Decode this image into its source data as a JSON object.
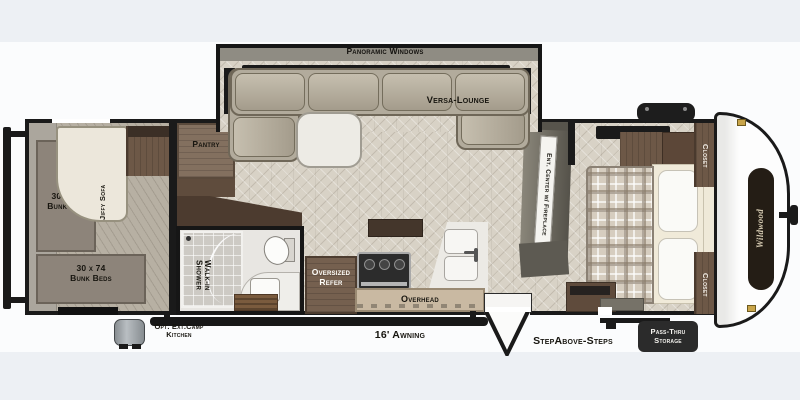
{
  "title": "Travel trailer floor plan",
  "labels": {
    "panoramic_windows": "Panoramic Windows",
    "versa_lounge": "Versa-Lounge",
    "pantry": "Pantry",
    "bunk_top_line1": "30 x 74",
    "bunk_top_line2": "Bunk Bed",
    "jiffy_sofa": "Jiffy Sofa",
    "bunk_bottom_line1": "30 x 74",
    "bunk_bottom_line2": "Bunk Beds",
    "walk_in": "Walk-in",
    "shower": "Shower",
    "oversized": "Oversized",
    "refer": "Refer",
    "overhead": "Overhead",
    "ent_center": "Ent. Center w/ Fireplace",
    "closet_top": "Closet",
    "closet_bottom": "Closet",
    "awning": "16' Awning",
    "steps": "StepAbove-Steps",
    "pass_thru_line1": "Pass-Thru",
    "pass_thru_line2": "Storage",
    "camp_line1": "Opt. Ext.Camp",
    "camp_line2": "Kitchen",
    "brand": "Wildwood"
  },
  "colors": {
    "wall": "#1a1a1a",
    "floor": "#d8d2c6",
    "sofa": "#b2ab9c",
    "cabinet_wood": "#6d5847",
    "counter": "#eceae5",
    "mattress_gray": "#8d847a",
    "bed_cream": "#f0ead9",
    "badge_dark": "#2b2b2b",
    "cap_white": "#fdfdfd",
    "hinge_gold": "#c9a54a",
    "background_band": "#edf0f4"
  }
}
